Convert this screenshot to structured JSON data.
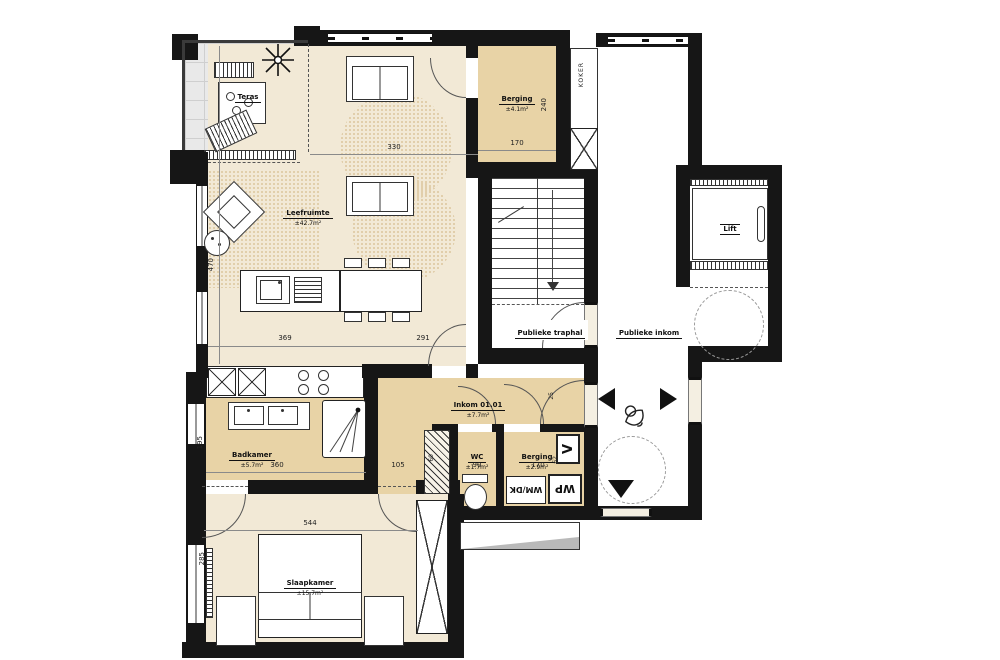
{
  "plan": {
    "rooms": {
      "teras": {
        "name": "Teras"
      },
      "leefruimte": {
        "name": "Leefruimte",
        "area": "±42.7m²"
      },
      "berging_boven": {
        "name": "Berging",
        "area": "±4.1m²"
      },
      "traphal": {
        "name": "Publieke traphal"
      },
      "inkom_publiek": {
        "name": "Publieke inkom"
      },
      "lift": {
        "name": "Lift"
      },
      "koker": {
        "name": "KOKER"
      },
      "inkom": {
        "name": "Inkom 01.01",
        "area": "±7.7m²"
      },
      "badkamer": {
        "name": "Badkamer",
        "area": "±5.7m²"
      },
      "wc": {
        "name": "WC",
        "area": "±1.7m²"
      },
      "berging_onder": {
        "name": "Berging",
        "area": "±2.9m²"
      },
      "slaapkamer": {
        "name": "Slaapkamer",
        "area": "±15.7m²"
      }
    },
    "appliances": {
      "washer": "WM/DK",
      "heatpump": "WP",
      "vent": "V"
    },
    "dimensions": {
      "d330": "330",
      "d170a": "170",
      "d240": "240",
      "d470": "470",
      "d369": "369",
      "d291": "291",
      "d360": "360",
      "d105": "105",
      "d195": "195",
      "d90": "90",
      "d170b": "170",
      "d60": "60",
      "d62": "62",
      "d25": "25",
      "d544": "544",
      "d285": "285"
    },
    "colors": {
      "wall": "#161616",
      "room_light": "#f2e9d6",
      "room_tan": "#e8d3a6",
      "terrace": "#e9e9e9"
    }
  }
}
